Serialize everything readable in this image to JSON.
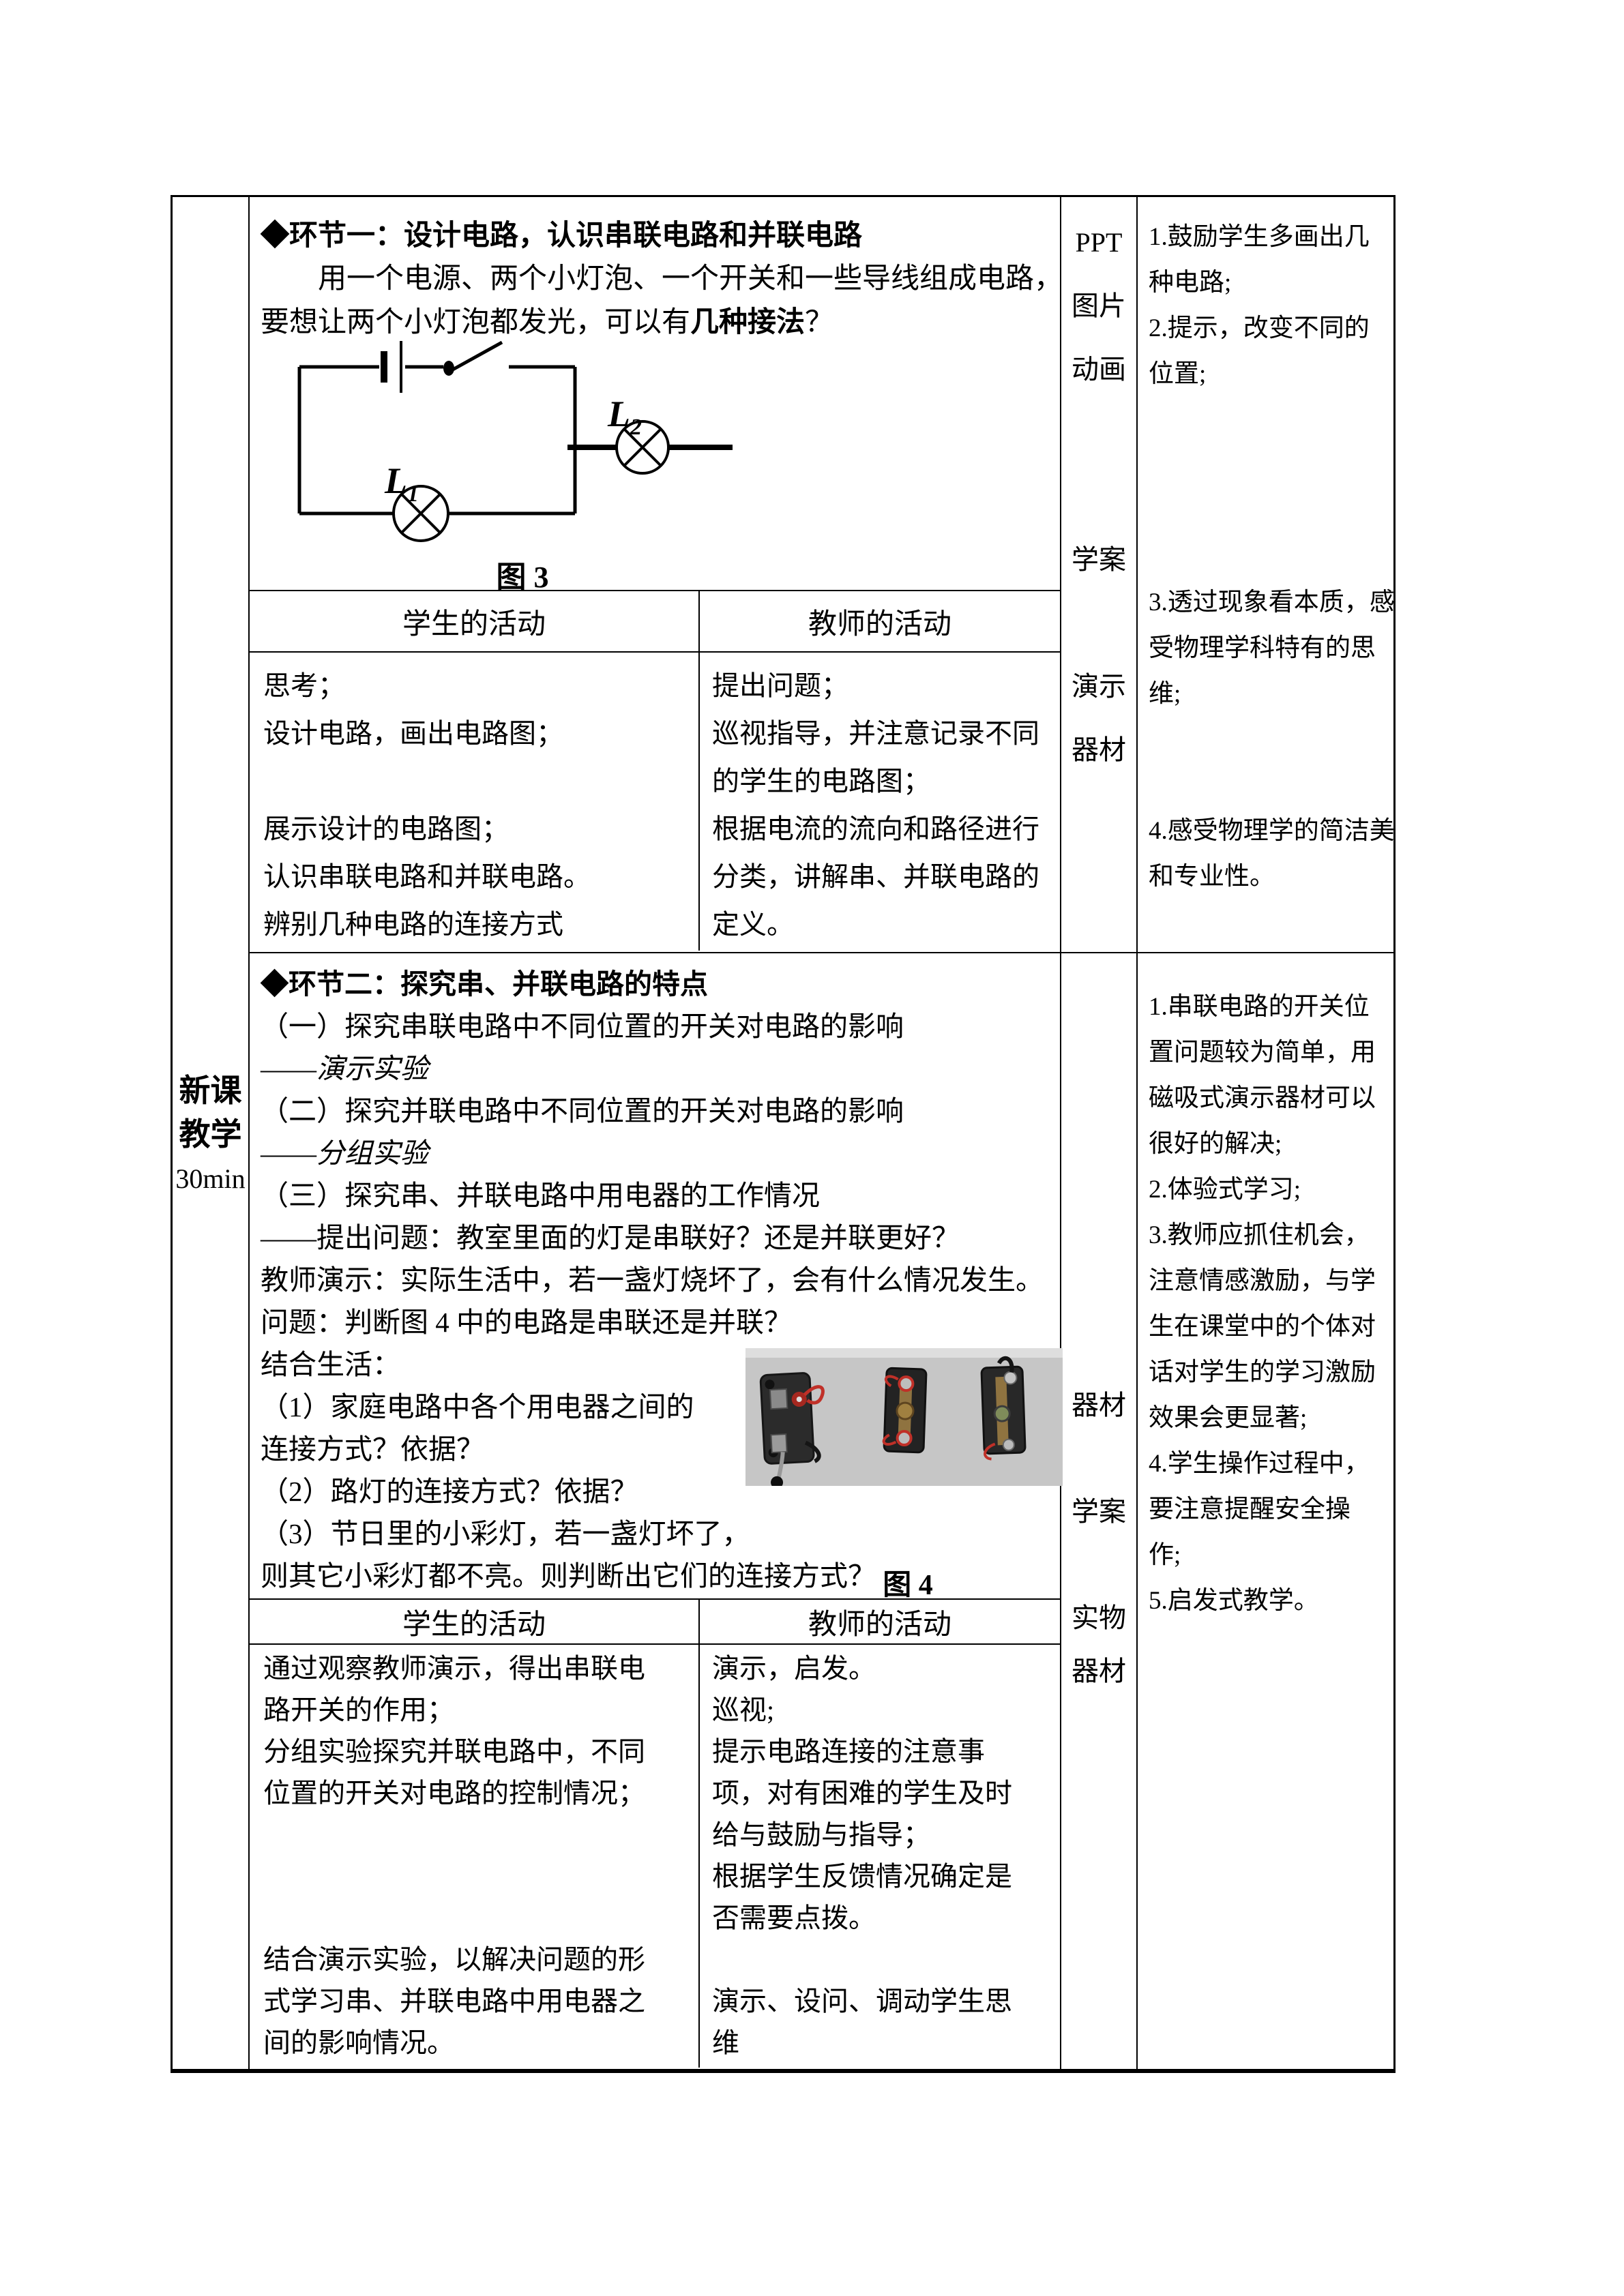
{
  "colors": {
    "text": "#000000",
    "border": "#000000",
    "photo_background": "#c6c6c6",
    "photo_switch_base": "#2b2b2b",
    "photo_brass": "#8f7340",
    "photo_wire_red": "#c03028"
  },
  "stage": {
    "lines": [
      "新课",
      "教学",
      "30min"
    ]
  },
  "section1": {
    "title": "◆环节一：设计电路，认识串联电路和并联电路",
    "paragraph": [
      {
        "parts": [
          {
            "t": "　　用一个电源、两个小灯泡、一个开关和一些导线组成电路，"
          }
        ]
      },
      {
        "parts": [
          {
            "t": "要想让两个小灯泡都发光，可以有"
          },
          {
            "t": "几种接法",
            "b": true
          },
          {
            "t": "？"
          }
        ]
      }
    ],
    "figure3": {
      "lamp1_label": "L",
      "lamp1_sub": "1",
      "lamp2_label": "L",
      "lamp2_sub": "2",
      "caption": "图 3"
    },
    "activities": {
      "headers": [
        "学生的活动",
        "教师的活动"
      ],
      "student_lines": [
        "思考；",
        "设计电路，画出电路图；",
        "",
        "展示设计的电路图；",
        "认识串联电路和并联电路。",
        "辨别几种电路的连接方式"
      ],
      "teacher_lines": [
        "提出问题；",
        "巡视指导，并注意记录不同",
        "的学生的电路图；",
        "根据电流的流向和路径进行",
        "分类，讲解串、并联电路的",
        "定义。"
      ]
    },
    "media_items": [
      "PPT",
      "图片",
      "动画",
      "",
      "",
      "学案",
      "",
      "演示",
      "器材"
    ],
    "comment_lines": [
      "1.鼓励学生多画出几",
      "种电路;",
      "2.提示，改变不同的",
      "位置;",
      "",
      "",
      "",
      "",
      "3.透过现象看本质，感",
      "受物理学科特有的思",
      "维;",
      "",
      "",
      "4.感受物理学的简洁美",
      "和专业性。"
    ]
  },
  "section2": {
    "title": "◆环节二：探究串、并联电路的特点",
    "content_lines": [
      {
        "parts": [
          {
            "t": "（一）探究串联电路中不同位置的开关对电路的影响"
          }
        ]
      },
      {
        "parts": [
          {
            "t": "——"
          },
          {
            "t": "演示实验",
            "i": true
          }
        ]
      },
      {
        "parts": [
          {
            "t": "（二）探究并联电路中不同位置的开关对电路的影响"
          }
        ]
      },
      {
        "parts": [
          {
            "t": "——"
          },
          {
            "t": "分组实验",
            "i": true
          }
        ]
      },
      {
        "parts": [
          {
            "t": "（三）探究串、并联电路中用电器的工作情况"
          }
        ]
      },
      {
        "parts": [
          {
            "t": "——提出问题：教室里面的灯是串联好？还是并联更好？"
          }
        ]
      },
      {
        "parts": [
          {
            "t": "教师演示：实际生活中，若一盏灯烧坏了，会有什么情况发生。"
          }
        ]
      },
      {
        "parts": [
          {
            "t": "问题：判断图 4 中的电路是串联还是并联？"
          }
        ]
      },
      {
        "parts": [
          {
            "t": "结合生活："
          }
        ]
      },
      {
        "parts": [
          {
            "t": "（1）家庭电路中各个用电器之间的"
          }
        ]
      },
      {
        "parts": [
          {
            "t": "连接方式？依据？"
          }
        ]
      },
      {
        "parts": [
          {
            "t": "（2）路灯的连接方式？依据？"
          }
        ]
      },
      {
        "parts": [
          {
            "t": "（3）节日里的小彩灯，若一盏灯坏了，"
          }
        ]
      },
      {
        "parts": [
          {
            "t": "则其它小彩灯都不亮。则判断出它们的连接方式？"
          }
        ]
      }
    ],
    "figure4": {
      "caption": "图 4"
    },
    "activities": {
      "headers": [
        "学生的活动",
        "教师的活动"
      ],
      "student_lines": [
        "通过观察教师演示，得出串联电",
        "路开关的作用；",
        "分组实验探究并联电路中，不同",
        "位置的开关对电路的控制情况；",
        "",
        "",
        "",
        "结合演示实验，以解决问题的形",
        "式学习串、并联电路中用电器之",
        "间的影响情况。"
      ],
      "teacher_lines": [
        "演示，启发。",
        "巡视;",
        "提示电路连接的注意事",
        "项，对有困难的学生及时",
        "给与鼓励与指导；",
        "根据学生反馈情况确定是",
        "否需要点拨。",
        "",
        "演示、设问、调动学生思",
        "维"
      ]
    },
    "media_items": [
      "",
      "",
      "",
      "",
      "",
      "",
      "",
      "",
      "器材",
      "",
      "学案",
      "",
      "实物",
      "器材"
    ],
    "comment_lines": [
      "1.串联电路的开关位",
      "置问题较为简单，用",
      "磁吸式演示器材可以",
      "很好的解决;",
      "2.体验式学习;",
      "3.教师应抓住机会，",
      "注意情感激励，与学",
      "生在课堂中的个体对",
      "话对学生的学习激励",
      "效果会更显著;",
      "4.学生操作过程中，",
      "要注意提醒安全操",
      "作;",
      "5.启发式教学。"
    ]
  }
}
